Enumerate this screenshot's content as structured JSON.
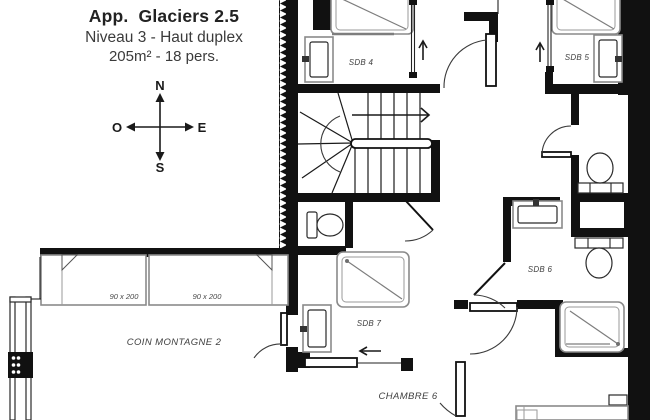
{
  "title_block": {
    "title": "App.  Glaciers 2.5",
    "subtitle": "Niveau 3 - Haut duplex",
    "details": "205m² - 18 pers."
  },
  "compass": {
    "north": "N",
    "south": "S",
    "east": "E",
    "west": "O"
  },
  "rooms": {
    "sdb4": {
      "label": "SDB 4"
    },
    "sdb5": {
      "label": "SDB 5"
    },
    "sdb6": {
      "label": "SDB 6"
    },
    "sdb7": {
      "label": "SDB 7"
    },
    "chambre6": {
      "label": "CHAMBRE 6"
    },
    "coin_montagne2": {
      "label": "COIN MONTAGNE 2"
    }
  },
  "beds": [
    {
      "size": "90 x 200"
    },
    {
      "size": "90 x 200"
    }
  ],
  "colors": {
    "wall": "#111111",
    "fixture_outline": "#8a8a8a",
    "label": "#3f3f3f",
    "background": "#ffffff"
  }
}
